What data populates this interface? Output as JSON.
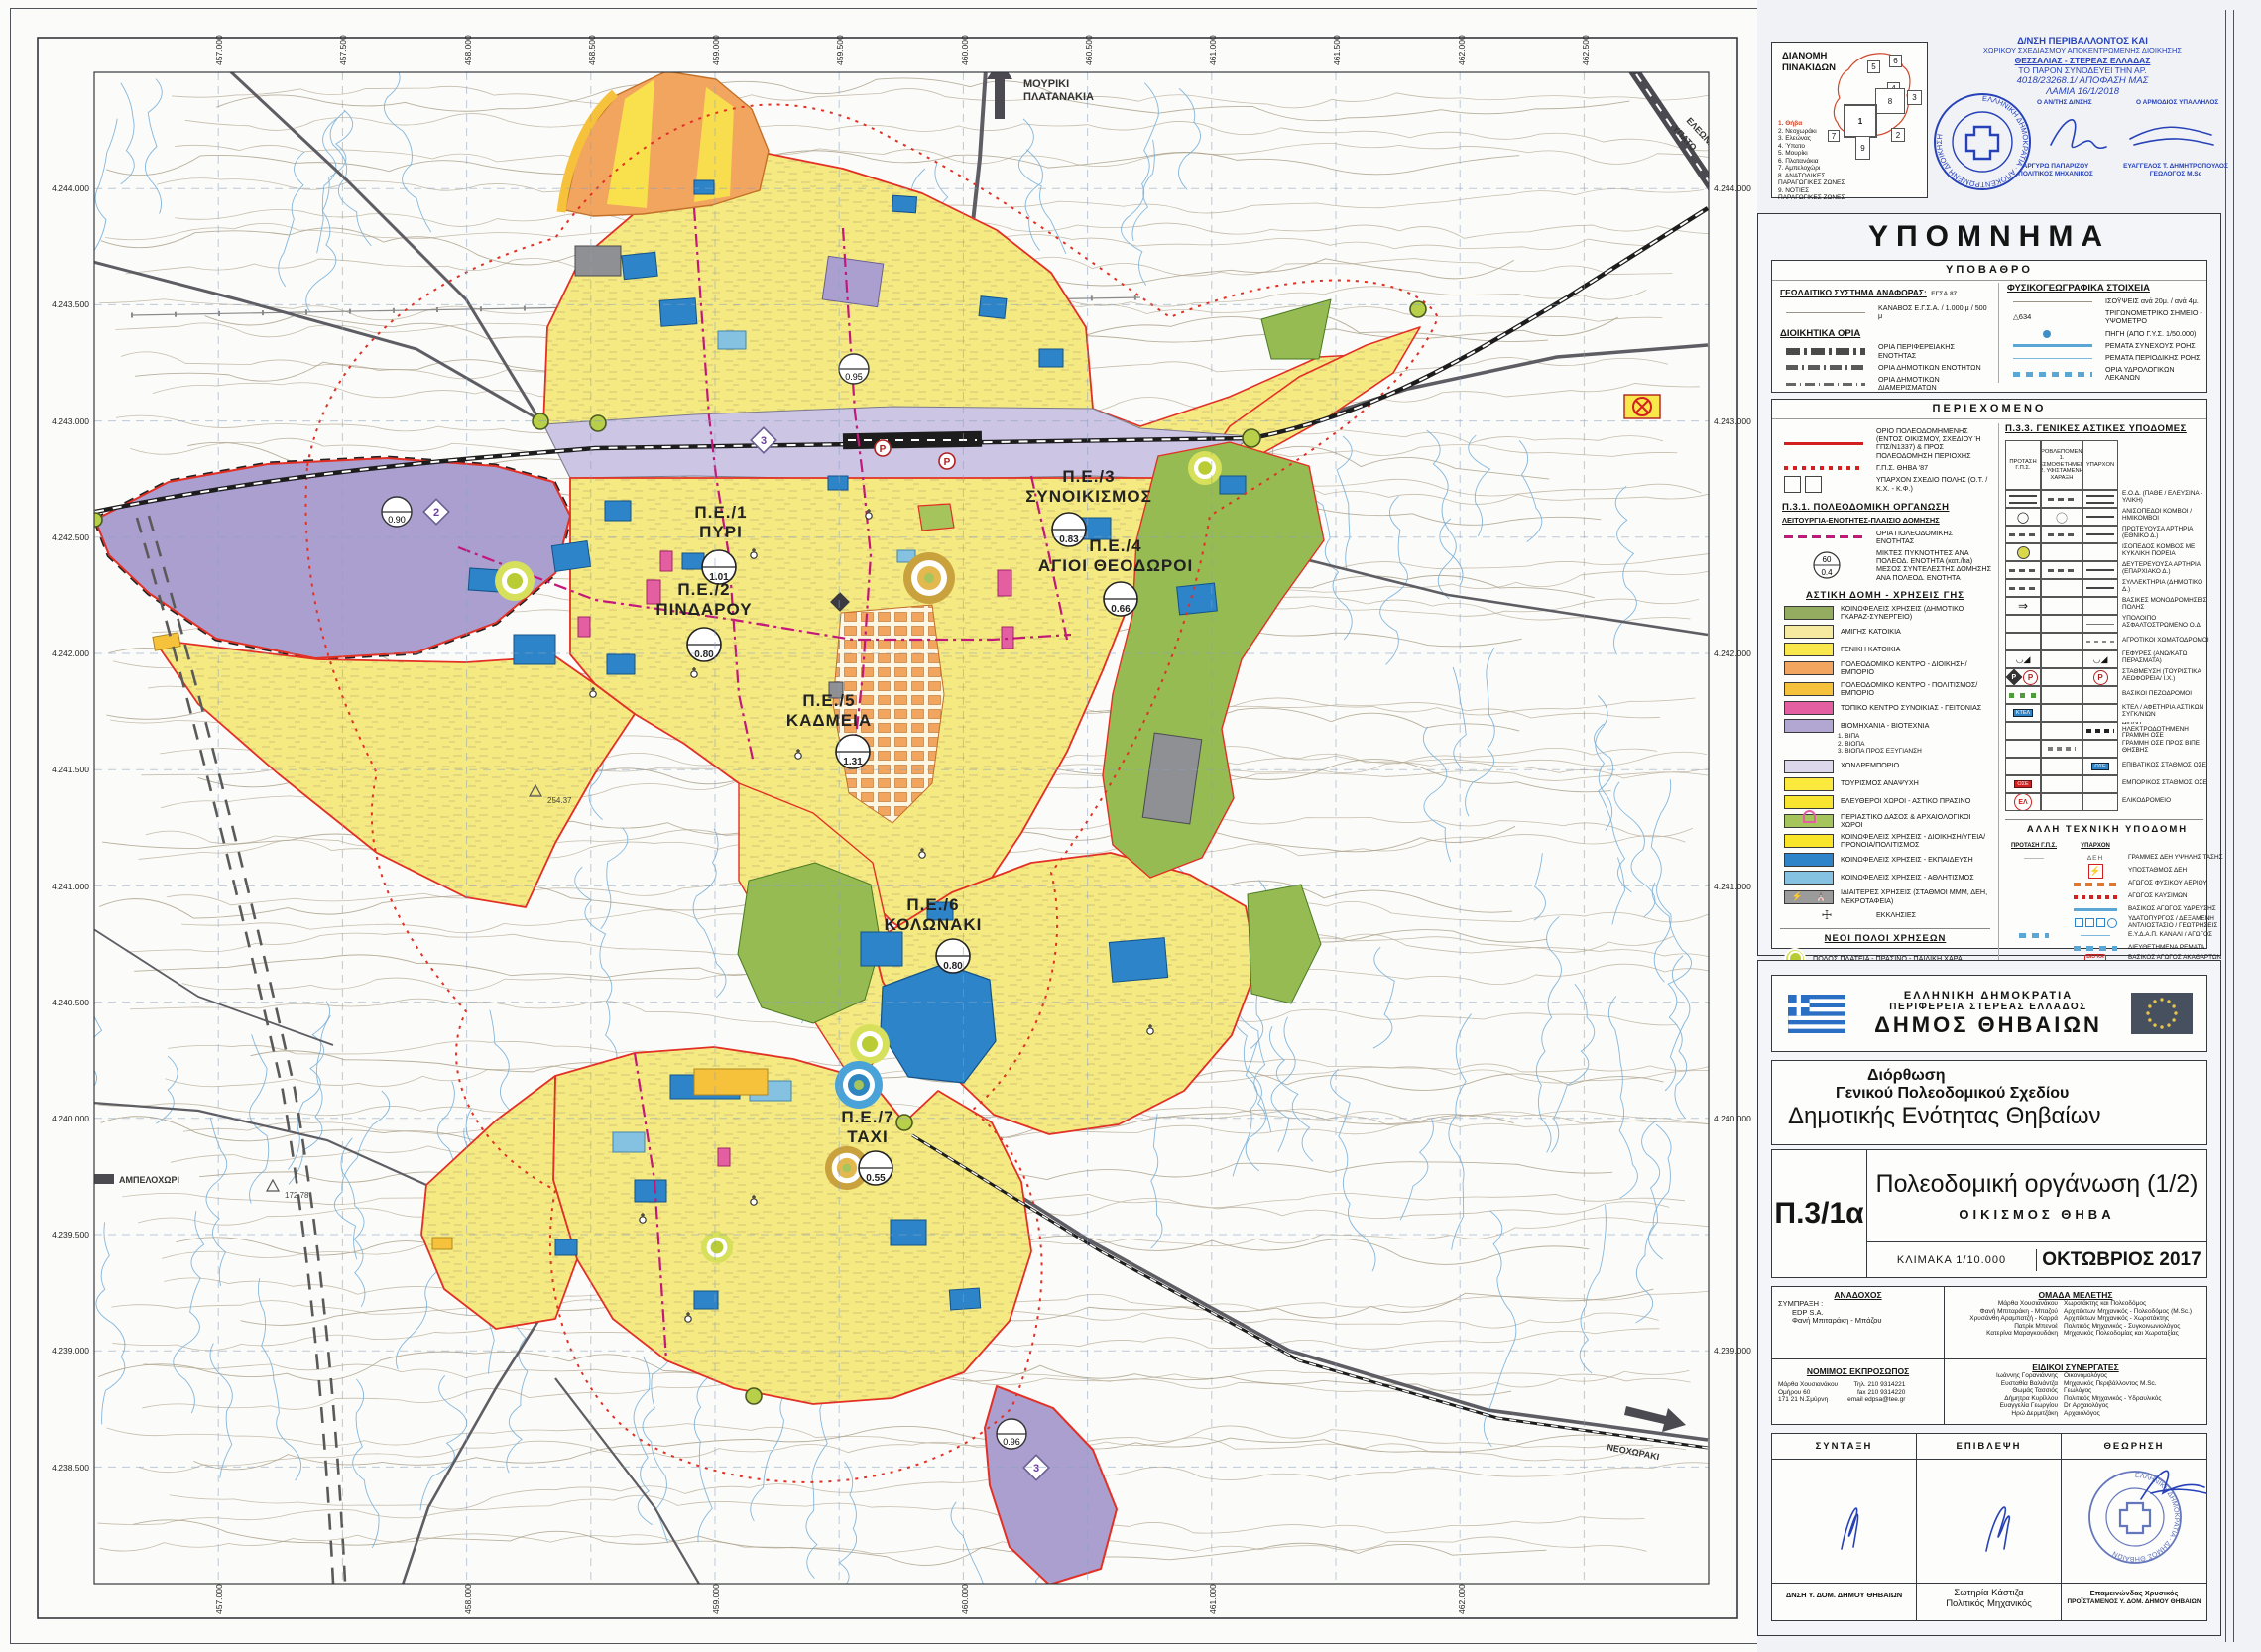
{
  "index_box": {
    "title1": "ΔΙΑΝΟΜΗ",
    "title2": "ΠΙΝΑΚΙΔΩΝ",
    "tiles": [
      "1",
      "2",
      "3",
      "4",
      "5",
      "6",
      "7",
      "8",
      "9"
    ],
    "items": [
      "1. Θήβα",
      "2. Νεοχωράκι",
      "3. Ελεώνας",
      "4. Ύπατο",
      "5. Μουρίκι",
      "6. Πλατανάκια",
      "7. Αμπελοχώρι",
      "8. ΑΝΑΤΟΛΙΚΕΣ ΠΑΡΑΓΩΓΙΚΕΣ ΖΩΝΕΣ",
      "9. ΝΟΤΙΕΣ ΠΑΡΑΓΩΓΙΚΕΣ ΖΩΝΕΣ"
    ]
  },
  "stamp": {
    "line1": "Δ/ΝΣΗ ΠΕΡΙΒΑΛΛΟΝΤΟΣ ΚΑΙ",
    "line2": "ΧΩΡΙΚΟΥ ΣΧΕΔΙΑΣΜΟΥ ΑΠΟΚΕΝΤΡΩΜΕΝΗΣ ΔΙΟΙΚΗΣΗΣ",
    "line3": "ΘΕΣΣΑΛΙΑΣ - ΣΤΕΡΕΑΣ ΕΛΛΑΔΑΣ",
    "line4": "ΤΟ ΠΑΡΟΝ ΣΥΝΟΔΕΥΕΙ ΤΗΝ ΑΡ.",
    "line5": "4018/23268.1/ ΑΠΟΦΑΣΗ ΜΑΣ",
    "line6": "ΛΑΜΙΑ 16/1/2018",
    "role_left": "Ο ΑΝ/ΤΗΣ Δ/ΝΣΗΣ",
    "role_right": "Ο ΑΡΜΟΔΙΟΣ ΥΠΑΛΛΗΛΟΣ",
    "name_left1": "ΑΡΓΥΡΩ ΠΑΠΑΡΙΖΟΥ",
    "name_left2": "ΠΟΛΙΤΙΚΟΣ ΜΗΧΑΝΙΚΟΣ",
    "name_right1": "ΕΥΑΓΓΕΛΟΣ Τ. ΔΗΜΗΤΡΟΠΟΥΛΟΣ",
    "name_right2": "ΓΕΩΛΟΓΟΣ M.Sc",
    "round_text": "ΕΛΛΗΝΙΚΗ ΔΗΜΟΚΡΑΤΙΑ · ΑΠΟΚΕΝΤΡΩΜΕΝΗ ΔΙΟΙΚΗΣΗ"
  },
  "legend": {
    "title": "ΥΠΟΜΝΗΜΑ",
    "ypovathro": {
      "title": "ΥΠΟΒΑΘΡΟ",
      "geo_label": "ΓΕΩΔΑΙΤΙΚΟ ΣΥΣΤΗΜΑ ΑΝΑΦΟΡΑΣ:",
      "geo_value": "ΕΓΣΑ 87",
      "kanavos": "ΚΑΝΑΒΟΣ Ε.Γ.Σ.Α. / 1.000 μ / 500 μ",
      "admin_title": "ΔΙΟΙΚΗΤΙΚΑ ΟΡΙΑ",
      "admin": [
        "ΟΡΙΑ ΠΕΡΙΦΕΡΕΙΑΚΗΣ ΕΝΟΤΗΤΑΣ",
        "ΟΡΙΑ ΔΗΜΟΤΙΚΩΝ ΕΝΟΤΗΤΩΝ",
        "ΟΡΙΑ ΔΗΜΟΤΙΚΩΝ ΔΙΑΜΕΡΙΣΜΑΤΩΝ"
      ],
      "physio_title": "ΦΥΣΙΚΟΓΕΩΓΡΑΦΙΚΑ ΣΤΟΙΧΕΙΑ",
      "physio": [
        "ΙΣΟΫΨΕΙΣ ανά 20μ. / ανά 4μ.",
        "ΤΡΙΓΩΝΟΜΕΤΡΙΚΟ ΣΗΜΕΙΟ - ΥΨΟΜΕΤΡΟ",
        "ΠΗΓΗ (ΑΠΟ Γ.Υ.Σ. 1/50.000)",
        "ΡΕΜΑΤΑ ΣΥΝΕΧΟΥΣ ΡΟΗΣ",
        "ΡΕΜΑΤΑ ΠΕΡΙΟΔΙΚΗΣ ΡΟΗΣ",
        "ΟΡΙΑ ΥΔΡΟΛΟΓΙΚΩΝ ΛΕΚΑΝΩΝ"
      ],
      "tri_value": "634"
    },
    "periexomeno": {
      "title": "ΠΕΡΙΕΧΟΜΕΝΟ",
      "intro": [
        "ΟΡΙΟ ΠΟΛΕΟΔΟΜΗΜΕΝΗΣ (ΕΝΤΟΣ ΟΙΚΙΣΜΟΥ, ΣΧΕΔΙΟΥ Ή ΓΠΣ/Ν1337) & ΠΡΟΣ ΠΟΛΕΟΔΟΜΗΣΗ ΠΕΡΙΟΧΗΣ",
        "Γ.Π.Σ. ΘΗΒΑ '87",
        "ΥΠΑΡΧΟΝ ΣΧΕΔΙΟ ΠΟΛΗΣ (Ο.Τ. / Κ.Χ. - Κ.Φ.)"
      ],
      "p31_title": "Π.3.1. ΠΟΛΕΟΔΟΜΙΚΗ ΟΡΓΑΝΩΣΗ",
      "p31_sub": "ΛΕΙΤΟΥΡΓΙΑ-ΕΝΟΤΗΤΕΣ-ΠΛΑΙΣΙΟ ΔΟΜΗΣΗΣ",
      "p31_row1": "ΟΡΙΑ ΠΟΛΕΟΔΟΜΙΚΗΣ ΕΝΟΤΗΤΑΣ",
      "p31_row2a": "ΜΙΚΤΕΣ ΠΥΚΝΟΤΗΤΕΣ ΑΝΑ ΠΟΛΕΟΔ. ΕΝΟΤΗΤΑ (κατ./ha)",
      "p31_row2b": "ΜΕΣΟΣ ΣΥΝΤΕΛΕΣΤΗΣ ΔΟΜΗΣΗΣ ΑΝΑ ΠΟΛΕΟΔ. ΕΝΟΤΗΤΑ",
      "dens_top": "60",
      "dens_bot": "0.4",
      "landuse_title": "ΑΣΤΙΚΗ ΔΟΜΗ - ΧΡΗΣΕΙΣ ΓΗΣ",
      "land_uses": [
        {
          "label": "ΚΟΙΝΩΦΕΛΕΙΣ ΧΡΗΣΕΙΣ (ΔΗΜΟΤΙΚΟ ΓΚΑΡΑΖ-ΣΥΝΕΡΓΕΙΟ)",
          "color": "#93ac60"
        },
        {
          "label": "ΑΜΙΓΗΣ ΚΑΤΟΙΚΙΑ",
          "color": "#f6e9a0"
        },
        {
          "label": "ΓΕΝΙΚΗ ΚΑΤΟΙΚΙΑ",
          "color": "#f9e84b"
        },
        {
          "label": "ΠΟΛΕΟΔΟΜΙΚΟ ΚΕΝΤΡΟ - ΔΙΟΙΚΗΣΗ/ΕΜΠΟΡΙΟ",
          "color": "#f2a55e"
        },
        {
          "label": "ΠΟΛΕΟΔΟΜΙΚΟ ΚΕΝΤΡΟ - ΠΟΛΙΤΙΣΜΟΣ/ΕΜΠΟΡΙΟ",
          "color": "#f6c23c"
        },
        {
          "label": "ΤΟΠΙΚΟ ΚΕΝΤΡΟ ΣΥΝΟΙΚΙΑΣ - ΓΕΙΤΟΝΙΑΣ",
          "color": "#e45fa2"
        },
        {
          "label": "ΒΙΟΜΗΧΑΝΙΑ - ΒΙΟΤΕΧΝΙΑ",
          "color": "#b2a6d2",
          "subs": [
            "1. ΒΙΠΑ",
            "2. ΒΙΟΠΑ",
            "3. ΒΙΟΠΑ ΠΡΟΣ ΕΞΥΓΙΑΝΣΗ"
          ]
        },
        {
          "label": "ΧΟΝΔΡΕΜΠΟΡΙΟ",
          "color": "#ddd7ec"
        },
        {
          "label": "ΤΟΥΡΙΣΜΟΣ ΑΝΑΨΥΧΗ",
          "color": "#fbe93e"
        },
        {
          "label": "ΕΛΕΥΘΕΡΟΙ ΧΩΡΟΙ - ΑΣΤΙΚΟ ΠΡΑΣΙΝΟ",
          "color": "#f8e530"
        },
        {
          "label": "ΠΕΡΙΑΣΤΙΚΟ ΔΑΣΟΣ & ΑΡΧΑΙΟΛΟΓΙΚΟΙ ΧΩΡΟΙ",
          "color": "#a5c45c"
        },
        {
          "label": "ΚΟΙΝΩΦΕΛΕΙΣ ΧΡΗΣΕΙΣ - ΔΙΟΙΚΗΣΗ/ΥΓΕΙΑ/ΠΡΟΝΟΙΑ/ΠΟΛΙΤΙΣΜΟΣ",
          "color": "#f9e62a"
        },
        {
          "label": "ΚΟΙΝΩΦΕΛΕΙΣ ΧΡΗΣΕΙΣ - ΕΚΠΑΙΔΕΥΣΗ",
          "color": "#2d84c8"
        },
        {
          "label": "ΚΟΙΝΩΦΕΛΕΙΣ ΧΡΗΣΕΙΣ - ΑΘΛΗΤΙΣΜΟΣ",
          "color": "#85c2e2"
        },
        {
          "label": "ΙΔΙΑΙΤΕΡΕΣ ΧΡΗΣΕΙΣ (ΣΤΑΘΜΟΙ ΜΜΜ, ΔΕΗ, ΝΕΚΡΟΤΑΦΕΙΑ)",
          "color": "#9b9b9b"
        },
        {
          "label": "ΕΚΚΛΗΣΙΕΣ",
          "color": ""
        }
      ],
      "poles_title": "ΝΕΟΙ ΠΟΛΟΙ ΧΡΗΣΕΩΝ",
      "poles": [
        "ΠΟΛΟΣ ΠΛΑΤΕΙΑ - ΠΡΑΣΙΝΟ - ΠΑΙΔΙΚΗ ΧΑΡΑ",
        "ΠΟΛΟΣ ΑΘΛΗΤΙΣΜΟΥ Ή/ΚΑΙ ΕΚΠΑΙΔΕΥΣΗ - ΠΡΑΣΙΝΟ",
        "ΠΟΛΟΣ ΥΓΕΙΑ - ΠΡΟΝΟΙΑ - ΠΡΑΣΙΝΟ"
      ],
      "p33_title": "Π.3.3. ΓΕΝΙΚΕΣ ΑΣΤΙΚΕΣ ΥΠΟΔΟΜΕΣ",
      "p33_h1": "ΠΡΟΤΑΣΗ Γ.Π.Σ.",
      "p33_h2": "ΠΡΟΒΛΕΠΟΜΕΝΟ 1. ΘΕΣΜΟΘΕΤΗΜΕΝΗ 2. ΥΦΙΣΤΑΜΕΝΗ ΧΑΡΑΞΗ",
      "p33_h3": "ΥΠΑΡΧΟΝ",
      "p33_rows": [
        "Ε.Ο.Δ. (ΠΑΘΕ / ΕΛΕΥΣΙΝΑ - ΥΛΙΚΗ)",
        "ΑΝΙΣΟΠΕΔΟΙ ΚΟΜΒΟΙ / ΗΜΙΚΟΜΒΟΙ",
        "ΠΡΩΤΕΥΟΥΣΑ ΑΡΤΗΡΙΑ (ΕΘΝΙΚΟ Δ.)",
        "ΙΣΟΠΕΔΟΣ ΚΟΜΒΟΣ ΜΕ ΚΥΚΛΙΚΗ ΠΟΡΕΙΑ",
        "ΔΕΥΤΕΡΕΥΟΥΣΑ ΑΡΤΗΡΙΑ (ΕΠΑΡΧΙΑΚΟ Δ.)",
        "ΣΥΛΛΕΚΤΗΡΙΑ (ΔΗΜΟΤΙΚΟ Δ.)",
        "ΒΑΣΙΚΕΣ ΜΟΝΟΔΡΟΜΗΣΕΙΣ ΠΟΛΗΣ",
        "ΥΠΟΛΟΙΠΟ ΑΣΦΑΛΤΟΣΤΡΩΜΕΝΟ Ο.Δ.",
        "ΑΓΡΟΤΙΚΟΙ ΧΩΜΑΤΟΔΡΟΜΟΙ",
        "ΓΕΦΥΡΕΣ (ΑΝΩ/ΚΑΤΩ ΠΕΡΑΣΜΑΤΑ)",
        "ΣΤΑΘΜΕΥΣΗ (ΤΟΥΡΙΣΤΙΚΑ ΛΕΩΦΟΡΕΙΑ/ Ι.Χ.)",
        "ΒΑΣΙΚΟΙ ΠΕΖΟΔΡΟΜΟΙ",
        "ΚΤΕΛ / ΑΦΕΤΗΡΙΑ ΑΣΤΙΚΩΝ ΣΥΓΚ/ΝΙΩΝ",
        "ΔΙΠΛΗ ΗΛΕΚΤΡΟΔΟΤΗΜΕΝΗ ΓΡΑΜΜΗ ΟΣΕ",
        "ΓΡΑΜΜΗ ΟΣΕ ΠΡΟΣ ΒΙΠΕ ΘΗΣΒΗΣ",
        "ΕΠΙΒΑΤΙΚΟΣ ΣΤΑΘΜΟΣ ΟΣΕ",
        "ΕΜΠΟΡΙΚΟΣ ΣΤΑΘΜΟΣ ΟΣΕ",
        "ΕΛΙΚΟΔΡΟΜΕΙΟ"
      ],
      "sym_ktel": "ΚΤΕΛ",
      "sym_ose": "ΟΣΕ",
      "sym_el": "ΕΛ",
      "sym_p": "P",
      "tech_title": "ΑΛΛΗ ΤΕΧΝΙΚΗ ΥΠΟΔΟΜΗ",
      "tech_h1": "ΠΡΟΤΑΣΗ Γ.Π.Σ.",
      "tech_h2": "ΥΠΑΡΧΟΝ",
      "tech_rows": [
        "ΓΡΑΜΜΕΣ ΔΕΗ ΥΨΗΛΗΣ ΤΑΣΗΣ",
        "ΥΠΟΣΤΑΘΜΟΣ ΔΕΗ",
        "ΑΓΩΓΟΣ ΦΥΣΙΚΟΥ ΑΕΡΙΟΥ",
        "ΑΓΩΓΟΣ ΚΑΥΣΙΜΩΝ",
        "ΒΑΣΙΚΟΣ ΑΓΩΓΟΣ ΥΔΡΕΥΣΗΣ",
        "ΥΔΑΤΟΠΥΡΓΟΣ / ΔΕΞΑΜΕΝΗ ΑΝΤΛΙΟΣΤΑΣΙΟ / ΓΕΩΤΡΗΣΕΙΣ",
        "Ε.Υ.Δ.Α.Π. ΚΑΝΑΛΙ / ΑΓΩΓΟΣ",
        "ΔΙΕΥΘΕΤΗΜΕΝΑ ΡΕΜΑΤΑ",
        "ΒΑΣΙΚΟΣ ΑΓΩΓΟΣ ΑΚΑΘΑΡΤΩΝ ΠΡΟΣ ΒΙΟΛΟΓΙΚΟ ΚΑΘΑΡΙΣΜΟ"
      ],
      "sym_deh": "ΔΕΗ",
      "sym_vioka": "ΒΙΟ ΚΑ"
    }
  },
  "map": {
    "pe_units": [
      {
        "name1": "Π.Ε./1",
        "name2": "ΠΥΡΙ",
        "value": "1.01"
      },
      {
        "name1": "Π.Ε./2",
        "name2": "ΠΙΝΔΑΡΟΥ",
        "value": "0.80"
      },
      {
        "name1": "Π.Ε./3",
        "name2": "ΣΥΝΟΙΚΙΣΜΟΣ",
        "value": "0.83"
      },
      {
        "name1": "Π.Ε./4",
        "name2": "ΑΓΙΟΙ ΘΕΟΔΩΡΟΙ",
        "value": "0.66"
      },
      {
        "name1": "Π.Ε./5",
        "name2": "ΚΑΔΜΕΙΑ",
        "value": "1.31"
      },
      {
        "name1": "Π.Ε./6",
        "name2": "ΚΟΛΩΝΑΚΙ",
        "value": "0.80"
      },
      {
        "name1": "Π.Ε./7",
        "name2": "ΤΑΧΙ",
        "value": "0.55"
      }
    ],
    "zone_marks": [
      {
        "num": "2",
        "value": "0.90"
      },
      {
        "num": "3",
        "value": "0.95"
      },
      {
        "num": "3",
        "value": "0.96"
      }
    ],
    "places": [
      "ΜΟΥΡΙΚΙ",
      "ΠΛΑΤΑΝΑΚΙΑ",
      "ΥΠΑΤΟ",
      "ΕΛΕΩΝΑΣ",
      "ΑΜΠΕΛΟΧΩΡΙ",
      "ΝΕΟΧΩΡΑΚΙ"
    ],
    "spot_heights": [
      "254.37",
      "172.78"
    ],
    "eastings": [
      "457.000",
      "457.500",
      "458.000",
      "458.500",
      "459.000",
      "459.500",
      "460.000",
      "460.500",
      "461.000",
      "461.500",
      "462.000",
      "462.500"
    ],
    "northings": [
      "4.244.000",
      "4.243.500",
      "4.243.000",
      "4.242.500",
      "4.242.000",
      "4.241.500",
      "4.241.000",
      "4.240.500",
      "4.240.000",
      "4.239.500",
      "4.239.000",
      "4.238.500"
    ]
  },
  "title_block": {
    "l1": "ΕΛΛΗΝΙΚΗ  ΔΗΜΟΚΡΑΤΙΑ",
    "l2": "ΠΕΡΙΦΕΡΕΙΑ ΣΤΕΡΕΑΣ ΕΛΛΑΔΟΣ",
    "l3": "ΔΗΜΟΣ ΘΗΒΑΙΩΝ",
    "p1": "Διόρθωση",
    "p2": "Γενικού Πολεοδομικού Σχεδίου",
    "p3": "Δημοτικής Ενότητας Θηβαίων"
  },
  "drawing": {
    "code": "Π.3/1α",
    "title": "Πολεοδομική οργάνωση (1/2)",
    "subtitle": "ΟΙΚΙΣΜΟΣ ΘΗΒΑ",
    "scale": "ΚΛΙΜΑΚΑ  1/10.000",
    "date": "ΟΚΤΩΒΡΙΟΣ 2017"
  },
  "credits": {
    "anadoxos_title": "ΑΝΑΔΟΧΟΣ",
    "symprax": "ΣΥΜΠΡΑΞΗ :",
    "firm": "EDP S.A.",
    "partner": "Φανή Μπιταράκη - Μπάζου",
    "team_title": "ΟΜΑΔΑ ΜΕΛΕΤΗΣ",
    "team": [
      {
        "n": "Μάρθα Χουσιανάκου",
        "r": "Χωροτάκτης και Πολεοδόμος"
      },
      {
        "n": "Φανή Μπιταράκη - Μπαζού",
        "r": "Αρχιτέκτων Μηχανικός - Πολεοδόμος (M.Sc.)"
      },
      {
        "n": "Χρυσάνθη Αραμπατζή - Καρρά",
        "r": "Αρχιτέκτων Μηχανικός - Χωροτάκτης"
      },
      {
        "n": "Πατρίκ Μπενοέ",
        "r": "Πολιτικός Μηχανικός - Συγκοινωνιολόγος"
      },
      {
        "n": "Κατερίνα Μαραγκουδάκη",
        "r": "Μηχανικός Πολεοδομίας και Χωροταξίας"
      }
    ],
    "rep_title": "ΝΟΜΙΜΟΣ ΕΚΠΡΟΣΩΠΟΣ",
    "rep_name": "Μάρθα Χουσιανάκου",
    "rep_addr1": "Ομήρου 60",
    "rep_addr2": "171 21 Ν.Σμύρνη",
    "rep_tel": "Τηλ. 210 9314221",
    "rep_fax": "fax 210 9314220",
    "rep_email": "email edpsa@tee.gr",
    "spec_title": "ΕΙΔΙΚΟΙ ΣΥΝΕΡΓΑΤΕΣ",
    "spec": [
      {
        "n": "Ιωάννης Γορανιάννης",
        "r": "Οικονομολόγος"
      },
      {
        "n": "Ευσταθία Βαλιάντζα",
        "r": "Μηχανικός Περιβάλλοντος M.Sc."
      },
      {
        "n": "Θωμάς Τασσιός",
        "r": "Γεωλόγος"
      },
      {
        "n": "Δήμητρα Κυρίλλου",
        "r": "Πολιτικός Μηχανικός - Υδραυλικός"
      },
      {
        "n": "Ευαγγελία Γεωργίου",
        "r": "Dr Αρχαιολόγος"
      },
      {
        "n": "Ηρώ Δερμιτζάκη",
        "r": "Αρχαιολόγος"
      }
    ]
  },
  "signoff": {
    "c1": "ΣΥΝΤΑΞΗ",
    "c2": "ΕΠΙΒΛΕΨΗ",
    "c3": "ΘΕΩΡΗΣΗ",
    "f1": "ΔΝΣΗ Υ. ΔΟΜ. ΔΗΜΟΥ ΘΗΒΑΙΩΝ",
    "f2a": "Σωτηρία Κάστιζα",
    "f2b": "Πολιτικός Μηχανικός",
    "f3a": "Επαμεινώνδας Χρυσικός",
    "f3b": "ΠΡΟΪΣΤΑΜΕΝΟΣ Υ. ΔΟΜ. ΔΗΜΟΥ ΘΗΒΑΙΩΝ",
    "stamp_text": "ΕΛΛΗΝΙΚΗ ΔΗΜΟΚΡΑΤΙΑ · ΔΗΜΟΣ ΘΗΒΑΙΩΝ"
  }
}
